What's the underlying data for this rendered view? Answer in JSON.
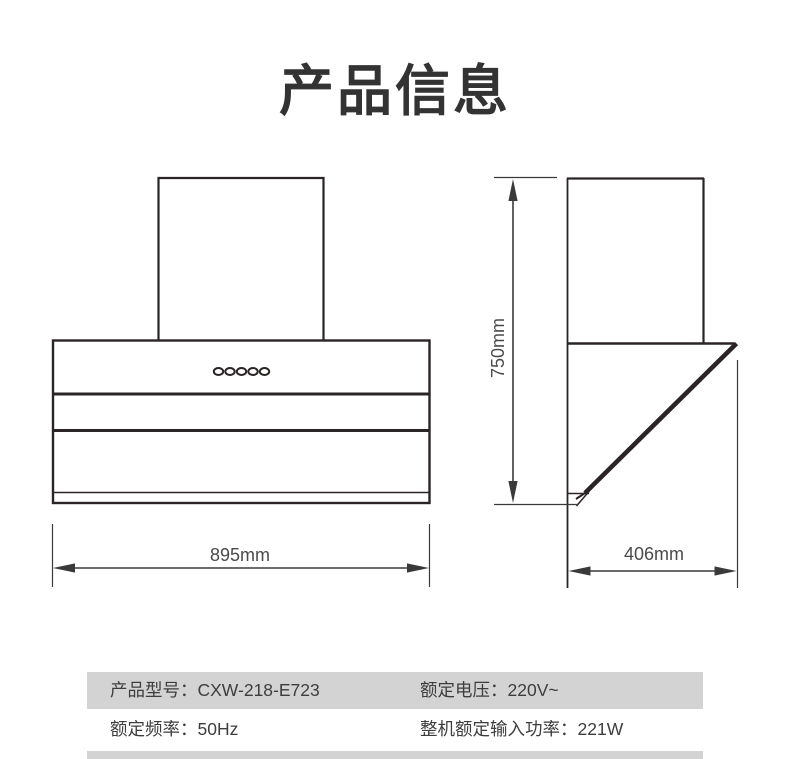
{
  "header": {
    "title": "产品信息"
  },
  "diagram": {
    "front_view": {
      "description": "range-hood-front-view",
      "width_dimension": "895mm",
      "control_buttons_count": 5
    },
    "side_view": {
      "description": "range-hood-side-view",
      "height_dimension": "750mm",
      "depth_dimension": "406mm"
    }
  },
  "spec_table": {
    "rows": [
      {
        "cells": [
          "产品型号：CXW-218-E723",
          "额定电压：220V~"
        ]
      },
      {
        "cells": [
          "额定频率：50Hz",
          "整机额定输入功率：221W"
        ]
      }
    ]
  },
  "colors": {
    "row_highlight_gray": "#d3d3d3",
    "drawing_line": "#2a2425",
    "dimension_line": "#3a3a3a",
    "text": "#3d3d3d",
    "title": "#333333"
  }
}
